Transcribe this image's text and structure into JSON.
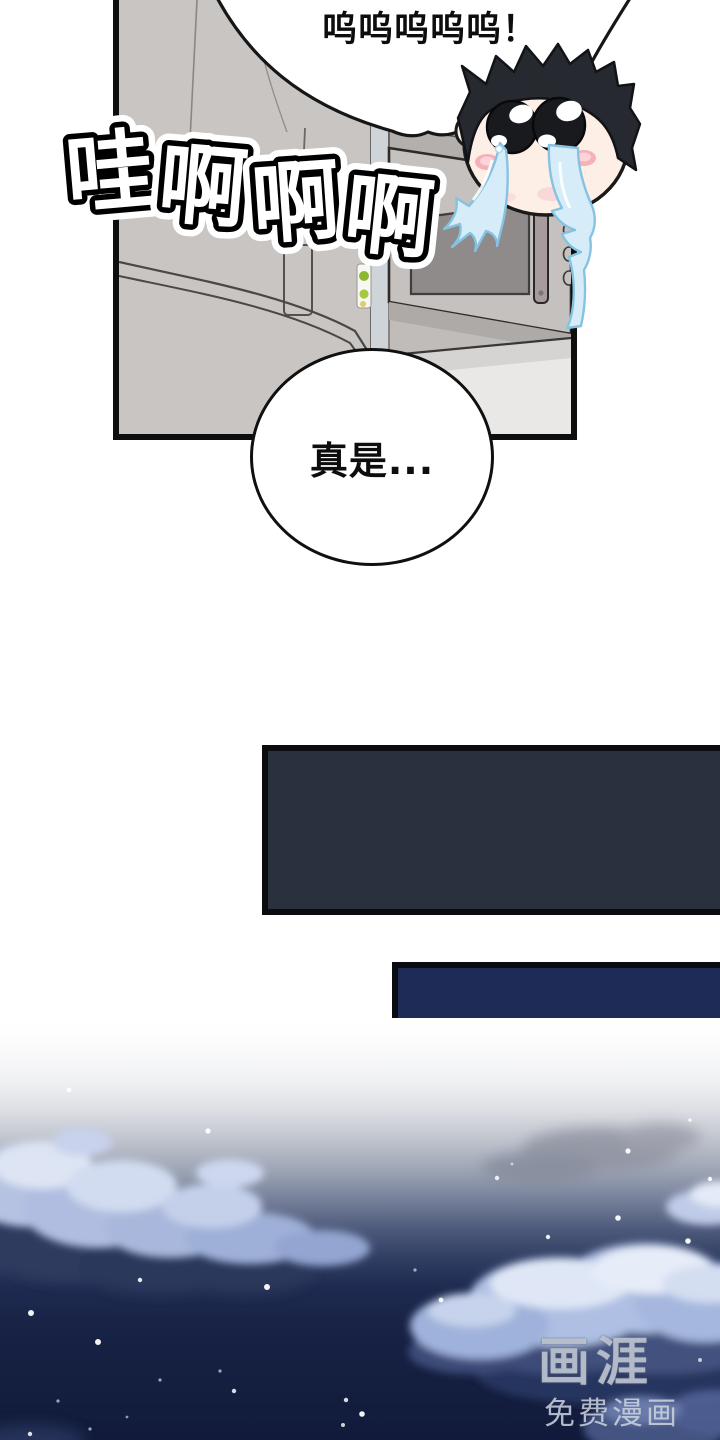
{
  "page": {
    "type": "webtoon comic page",
    "background": "#ffffff"
  },
  "speech": {
    "cry_bubble": "呜呜呜呜呜！",
    "thought_bubble": "真是..."
  },
  "sfx": {
    "text": "哇啊啊啊",
    "chars": [
      "哇",
      "啊",
      "啊",
      "啊"
    ]
  },
  "character": {
    "name": "crying chibi face",
    "emotion": "crying",
    "hair_color": "#26292f",
    "skin_color": "#fdeee6",
    "tear_color": "#d6edf9",
    "blush_color": "#f6b0ba"
  },
  "panels": {
    "kitchen": "kitchen scene with refrigerator, microwave and counter",
    "dark_wide_color": "#29303e",
    "dark_navy_color": "#1e2b56",
    "night_sky": "night sky gradient with clouds and stars"
  },
  "watermark": {
    "logo": "画涯",
    "subtitle": "免费漫画"
  },
  "colors": {
    "panel_border": "#0e0e0e",
    "fridge_gray": "#c9c5c2",
    "microwave_door": "#c5c1be",
    "microwave_window": "#8e8b8a",
    "sky_top": "#ffffff",
    "sky_bottom": "#111a3a",
    "cloud_light": "#b6c2e2",
    "cloud_dark": "#2e3a5e"
  }
}
